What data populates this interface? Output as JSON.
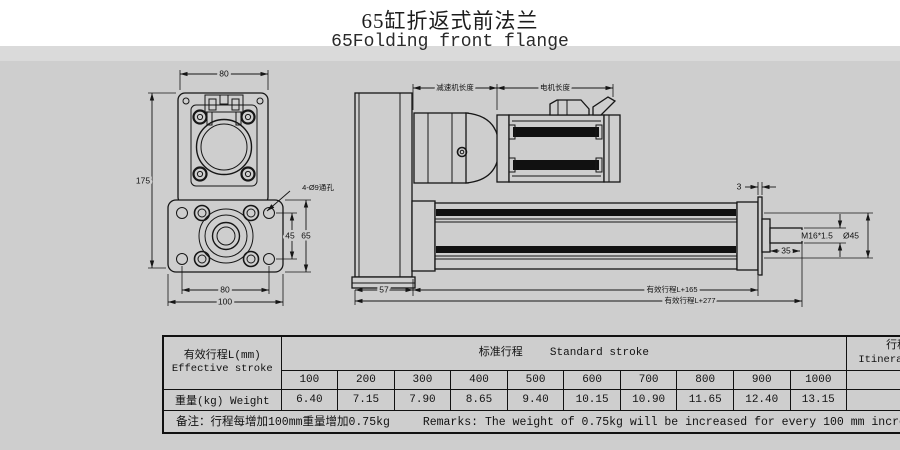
{
  "title": {
    "zh": "65缸折返式前法兰",
    "en": "65Folding front flange"
  },
  "drawing": {
    "front_view": {
      "dims": {
        "top_width": "80",
        "total_height": "175",
        "hole_span_vertical": "45",
        "plate_height": "65",
        "hole_span_horizontal": "80",
        "plate_width": "100"
      },
      "hole_note": "4-Ø9通孔"
    },
    "side_view": {
      "dims": {
        "reducer_length": "减速机长度",
        "motor_length": "电机长度",
        "plate_thickness": "3",
        "rod_thread": "M16*1.5",
        "flange_diameter": "Ø45",
        "rod_length": "35",
        "rear_width": "57",
        "stroke_plus_165": "有效行程L+165",
        "stroke_plus_277": "有效行程L+277"
      }
    }
  },
  "table": {
    "effective_stroke_header": {
      "zh": "有效行程L(mm)",
      "en": "Effective stroke"
    },
    "standard_stroke_header": {
      "zh": "标准行程",
      "en": "Standard stroke"
    },
    "suggestion_header": {
      "zh": "行程建议(mm)",
      "en": "Itinerary suggestion"
    },
    "weight_header": "重量(kg) Weight",
    "strokes": [
      "100",
      "200",
      "300",
      "400",
      "500",
      "600",
      "700",
      "800",
      "900",
      "1000"
    ],
    "weights": [
      "6.40",
      "7.15",
      "7.90",
      "8.65",
      "9.40",
      "10.15",
      "10.90",
      "11.65",
      "12.40",
      "13.15"
    ],
    "suggestion_value": "≦1000",
    "suggestion_weight": "...",
    "remarks": {
      "zh": "备注：行程每增加100mm重量增加0.75kg",
      "en": "Remarks: The weight of 0.75kg will be increased for every 100 mm increase in travel"
    }
  },
  "colors": {
    "background": "#cecece",
    "band": "#dadada",
    "paper": "#ffffff",
    "line": "#161616"
  }
}
